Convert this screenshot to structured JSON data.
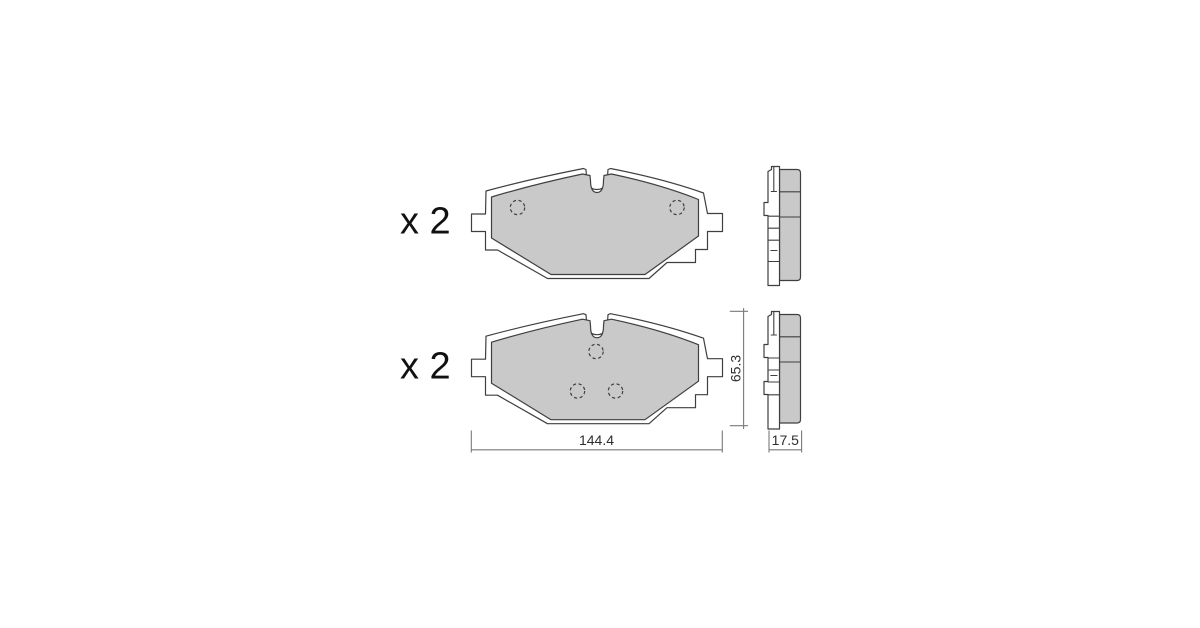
{
  "diagram": {
    "kind": "brake-pad-technical-drawing",
    "sets": [
      {
        "quantity_label": "x 2"
      },
      {
        "quantity_label": "x 2"
      }
    ],
    "dimensions": {
      "width_mm": "144.4",
      "height_mm": "65.3",
      "thickness_mm": "17.5"
    },
    "colors": {
      "pad-fill": "#c8c9c8",
      "outline": "#3f3f3f",
      "dim-line": "#7a7a7a",
      "dim-text": "#2e2e2e",
      "label-text": "#111111",
      "background": "#ffffff"
    }
  }
}
